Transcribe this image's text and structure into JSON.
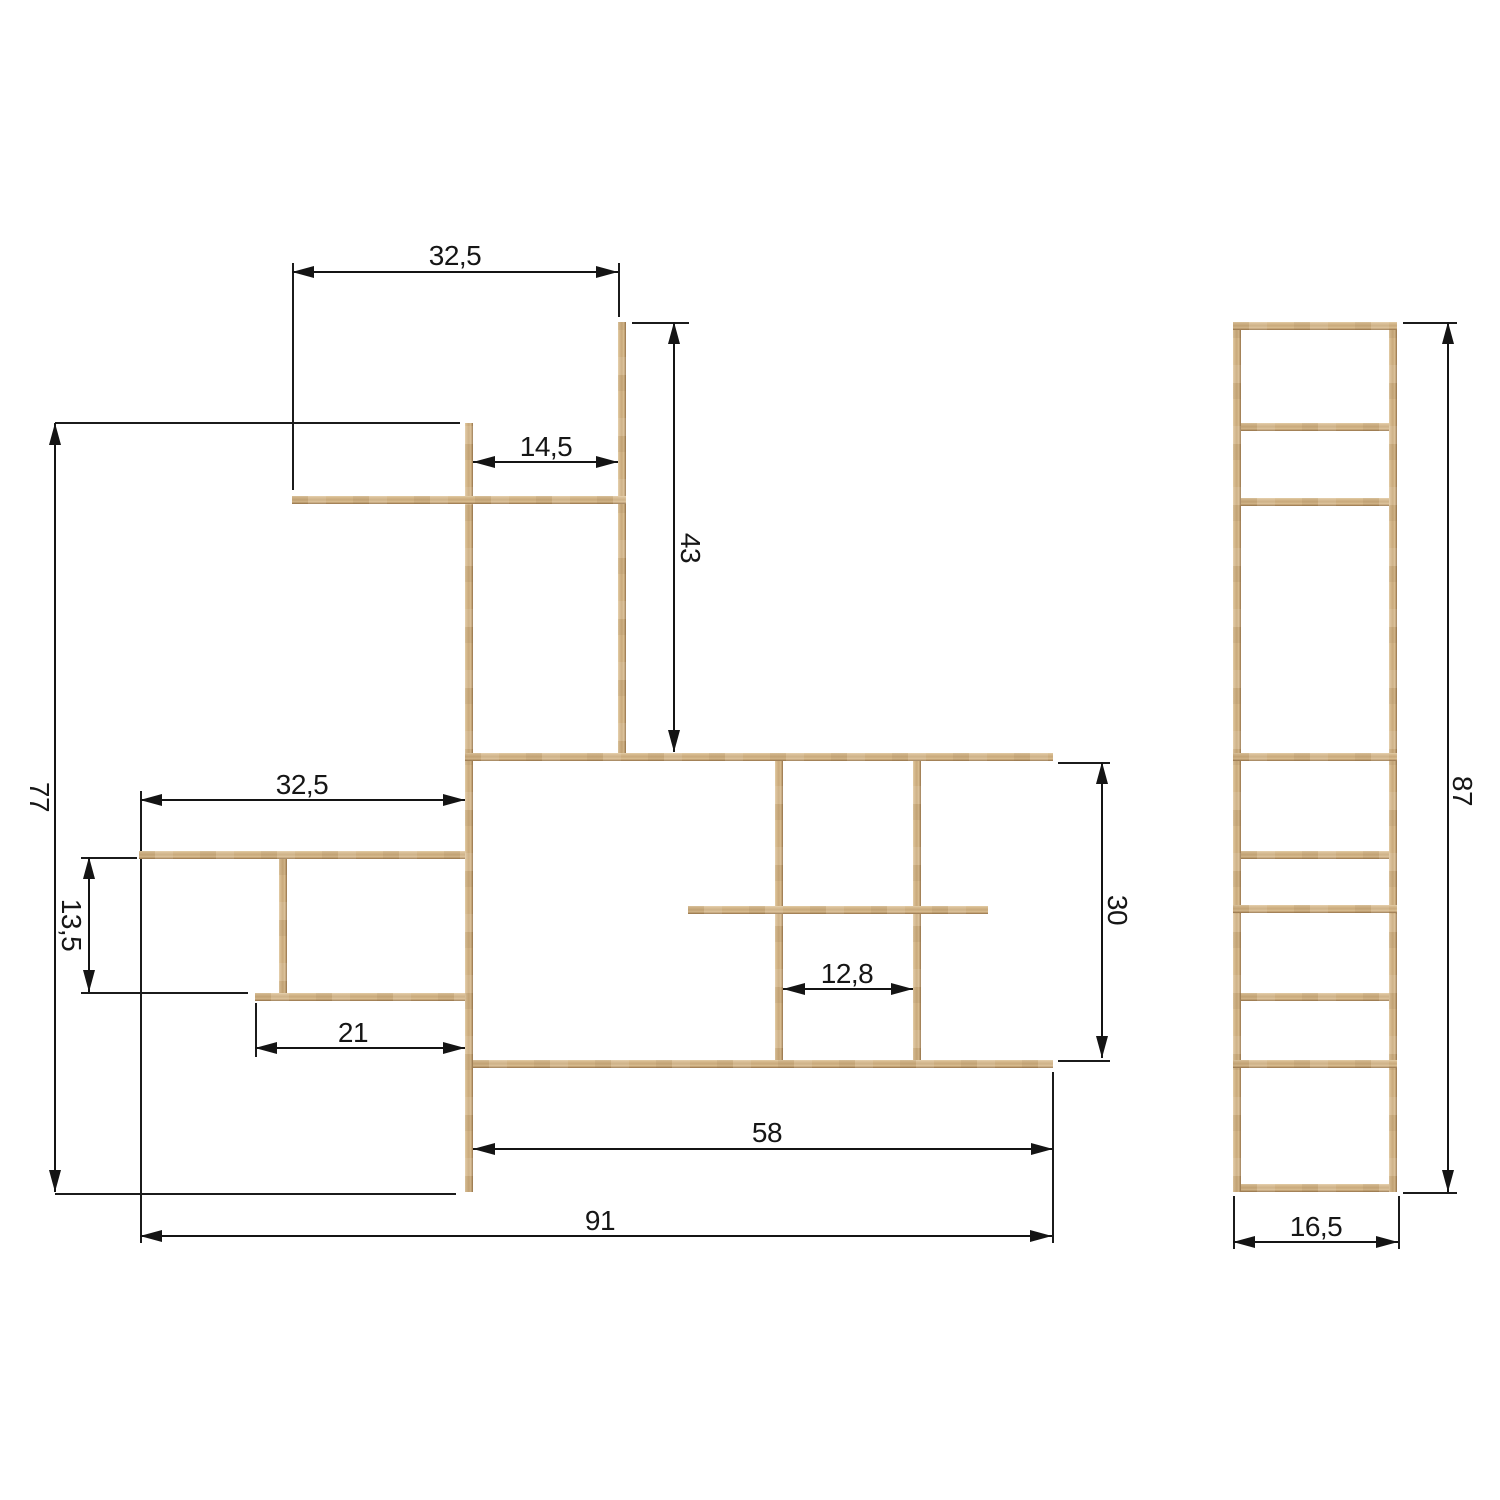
{
  "meta": {
    "title": "Shelving unit dimensional drawing",
    "views": [
      "front",
      "side"
    ],
    "scale_px_per_unit": 10
  },
  "colors": {
    "background": "#ffffff",
    "line": "#141414",
    "extension_line": "#1b1b1b",
    "wood_light": "#e3cca6",
    "wood_mid": "#c9a97b",
    "wood_dark": "#8e704a"
  },
  "front_view": {
    "bars": [
      {
        "name": "front-left-post",
        "x": 465,
        "y": 423,
        "w": 8,
        "h": 769
      },
      {
        "name": "front-top-post",
        "x": 618,
        "y": 322,
        "w": 8,
        "h": 435
      },
      {
        "name": "front-small-post",
        "x": 279,
        "y": 857,
        "w": 8,
        "h": 140
      },
      {
        "name": "front-mid-post-1",
        "x": 775,
        "y": 757,
        "w": 8,
        "h": 307
      },
      {
        "name": "front-mid-post-2",
        "x": 913,
        "y": 757,
        "w": 8,
        "h": 307
      },
      {
        "name": "front-top-left-shelf",
        "x": 292,
        "y": 496,
        "w": 334,
        "h": 8
      },
      {
        "name": "front-upper-long-shelf",
        "x": 465,
        "y": 753,
        "w": 588,
        "h": 8
      },
      {
        "name": "front-lower-long-shelf",
        "x": 473,
        "y": 1060,
        "w": 580,
        "h": 8
      },
      {
        "name": "front-mid-left-shelf",
        "x": 139,
        "y": 851,
        "w": 326,
        "h": 8
      },
      {
        "name": "front-lower-left-shelf",
        "x": 255,
        "y": 993,
        "w": 210,
        "h": 8
      },
      {
        "name": "front-mid-right-shelf",
        "x": 688,
        "y": 906,
        "w": 300,
        "h": 8
      }
    ]
  },
  "side_view": {
    "bars": [
      {
        "name": "side-left-rail",
        "x": 1233,
        "y": 322,
        "w": 8,
        "h": 870
      },
      {
        "name": "side-right-rail",
        "x": 1389,
        "y": 322,
        "w": 8,
        "h": 870
      },
      {
        "name": "side-top-bar",
        "x": 1233,
        "y": 322,
        "w": 164,
        "h": 8
      },
      {
        "name": "side-bar-2",
        "x": 1241,
        "y": 423,
        "w": 148,
        "h": 8
      },
      {
        "name": "side-bar-3",
        "x": 1241,
        "y": 498,
        "w": 148,
        "h": 8
      },
      {
        "name": "side-bar-4",
        "x": 1233,
        "y": 753,
        "w": 164,
        "h": 8
      },
      {
        "name": "side-bar-5",
        "x": 1241,
        "y": 851,
        "w": 148,
        "h": 8
      },
      {
        "name": "side-bar-6",
        "x": 1233,
        "y": 905,
        "w": 164,
        "h": 8
      },
      {
        "name": "side-bar-7",
        "x": 1241,
        "y": 993,
        "w": 148,
        "h": 8
      },
      {
        "name": "side-bar-8",
        "x": 1233,
        "y": 1060,
        "w": 164,
        "h": 8
      },
      {
        "name": "side-bottom-bar",
        "x": 1241,
        "y": 1184,
        "w": 148,
        "h": 8
      }
    ]
  },
  "extension_lines": [
    {
      "name": "ext-top-width-left",
      "orient": "v",
      "x": 292,
      "y": 263,
      "len": 227
    },
    {
      "name": "ext-top-width-right",
      "orient": "v",
      "x": 618,
      "y": 263,
      "len": 54
    },
    {
      "name": "ext-upper-height-top",
      "orient": "h",
      "x": 632,
      "y": 322,
      "len": 57
    },
    {
      "name": "ext-total-height-top",
      "orient": "h",
      "x": 55,
      "y": 422,
      "len": 405
    },
    {
      "name": "ext-total-height-bot",
      "orient": "h",
      "x": 55,
      "y": 1193,
      "len": 401
    },
    {
      "name": "ext-left-width-left",
      "orient": "v",
      "x": 140,
      "y": 791,
      "len": 452
    },
    {
      "name": "ext-left-height-top",
      "orient": "h",
      "x": 81,
      "y": 857,
      "len": 56
    },
    {
      "name": "ext-left-height-bot",
      "orient": "h",
      "x": 81,
      "y": 992,
      "len": 167
    },
    {
      "name": "ext-lower-left-width",
      "orient": "v",
      "x": 255,
      "y": 1003,
      "len": 54
    },
    {
      "name": "ext-mid-height-top",
      "orient": "h",
      "x": 1058,
      "y": 762,
      "len": 52
    },
    {
      "name": "ext-mid-height-bot",
      "orient": "h",
      "x": 1058,
      "y": 1060,
      "len": 52
    },
    {
      "name": "ext-lower-width-right",
      "orient": "v",
      "x": 1052,
      "y": 1072,
      "len": 171
    },
    {
      "name": "ext-side-height-top",
      "orient": "h",
      "x": 1403,
      "y": 322,
      "len": 54
    },
    {
      "name": "ext-side-height-bot",
      "orient": "h",
      "x": 1403,
      "y": 1192,
      "len": 54
    },
    {
      "name": "ext-side-depth-left",
      "orient": "v",
      "x": 1233,
      "y": 1196,
      "len": 53
    },
    {
      "name": "ext-side-depth-right",
      "orient": "v",
      "x": 1398,
      "y": 1196,
      "len": 53
    }
  ],
  "dimensions": [
    {
      "name": "dim-top-width",
      "orient": "h",
      "label": "32,5",
      "pos": 272,
      "from": 292,
      "to": 618,
      "label_x": 455,
      "label_y": 256,
      "rotated": false
    },
    {
      "name": "dim-upper-inner",
      "orient": "h",
      "label": "14,5",
      "pos": 462,
      "from": 473,
      "to": 618,
      "label_x": 546,
      "label_y": 447,
      "rotated": false
    },
    {
      "name": "dim-upper-height",
      "orient": "v",
      "label": "43",
      "pos": 674,
      "from": 322,
      "to": 752,
      "label_x": 690,
      "label_y": 548,
      "rotated": true
    },
    {
      "name": "dim-total-height",
      "orient": "v",
      "label": "77",
      "pos": 55,
      "from": 423,
      "to": 1192,
      "label_x": 39,
      "label_y": 797,
      "rotated": true
    },
    {
      "name": "dim-left-width",
      "orient": "h",
      "label": "32,5",
      "pos": 800,
      "from": 140,
      "to": 465,
      "label_x": 302,
      "label_y": 785,
      "rotated": false
    },
    {
      "name": "dim-left-height",
      "orient": "v",
      "label": "13,5",
      "pos": 89,
      "from": 857,
      "to": 992,
      "label_x": 71,
      "label_y": 925,
      "rotated": true
    },
    {
      "name": "dim-lower-left-width",
      "orient": "h",
      "label": "21",
      "pos": 1048,
      "from": 255,
      "to": 465,
      "label_x": 353,
      "label_y": 1033,
      "rotated": false
    },
    {
      "name": "dim-mid-gap",
      "orient": "h",
      "label": "12,8",
      "pos": 989,
      "from": 783,
      "to": 913,
      "label_x": 847,
      "label_y": 974,
      "rotated": false
    },
    {
      "name": "dim-mid-height",
      "orient": "v",
      "label": "30",
      "pos": 1102,
      "from": 762,
      "to": 1058,
      "label_x": 1117,
      "label_y": 910,
      "rotated": true
    },
    {
      "name": "dim-lower-width",
      "orient": "h",
      "label": "58",
      "pos": 1149,
      "from": 473,
      "to": 1053,
      "label_x": 767,
      "label_y": 1133,
      "rotated": false
    },
    {
      "name": "dim-total-width",
      "orient": "h",
      "label": "91",
      "pos": 1236,
      "from": 140,
      "to": 1052,
      "label_x": 600,
      "label_y": 1221,
      "rotated": false
    },
    {
      "name": "dim-side-height",
      "orient": "v",
      "label": "87",
      "pos": 1448,
      "from": 322,
      "to": 1192,
      "label_x": 1462,
      "label_y": 791,
      "rotated": true
    },
    {
      "name": "dim-side-depth",
      "orient": "h",
      "label": "16,5",
      "pos": 1242,
      "from": 1233,
      "to": 1398,
      "label_x": 1316,
      "label_y": 1227,
      "rotated": false
    }
  ]
}
